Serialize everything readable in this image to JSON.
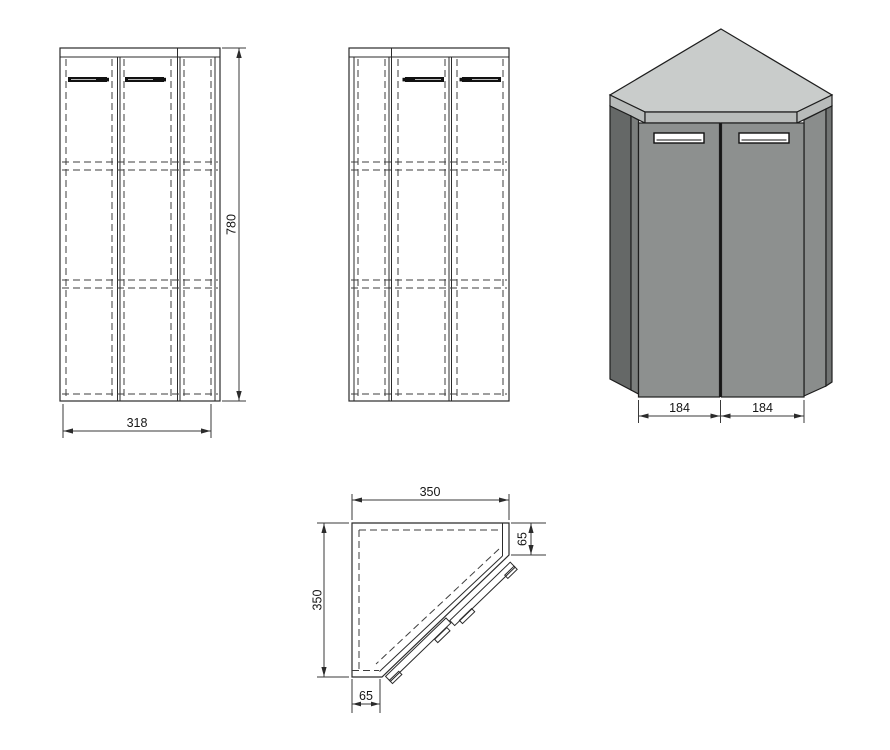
{
  "views": {
    "front": {
      "height_mm": "780",
      "width_mm": "318"
    },
    "isometric": {
      "left_door_mm": "184",
      "right_door_mm": "184"
    },
    "plan": {
      "width_mm": "350",
      "depth_mm": "350",
      "right_return_mm": "65",
      "bottom_return_mm": "65"
    }
  },
  "colors": {
    "background": "#ffffff",
    "line": "#2b2b2b",
    "top_face": "#c9cccb",
    "top_band": "#b8bbba",
    "door_face": "#8d908f",
    "side_left_dark": "#656867",
    "side_left_mid": "#7b7e7d",
    "side_right_mid": "#8a8d8c",
    "side_right_dark": "#717473",
    "handle_fill": "#ffffff"
  }
}
